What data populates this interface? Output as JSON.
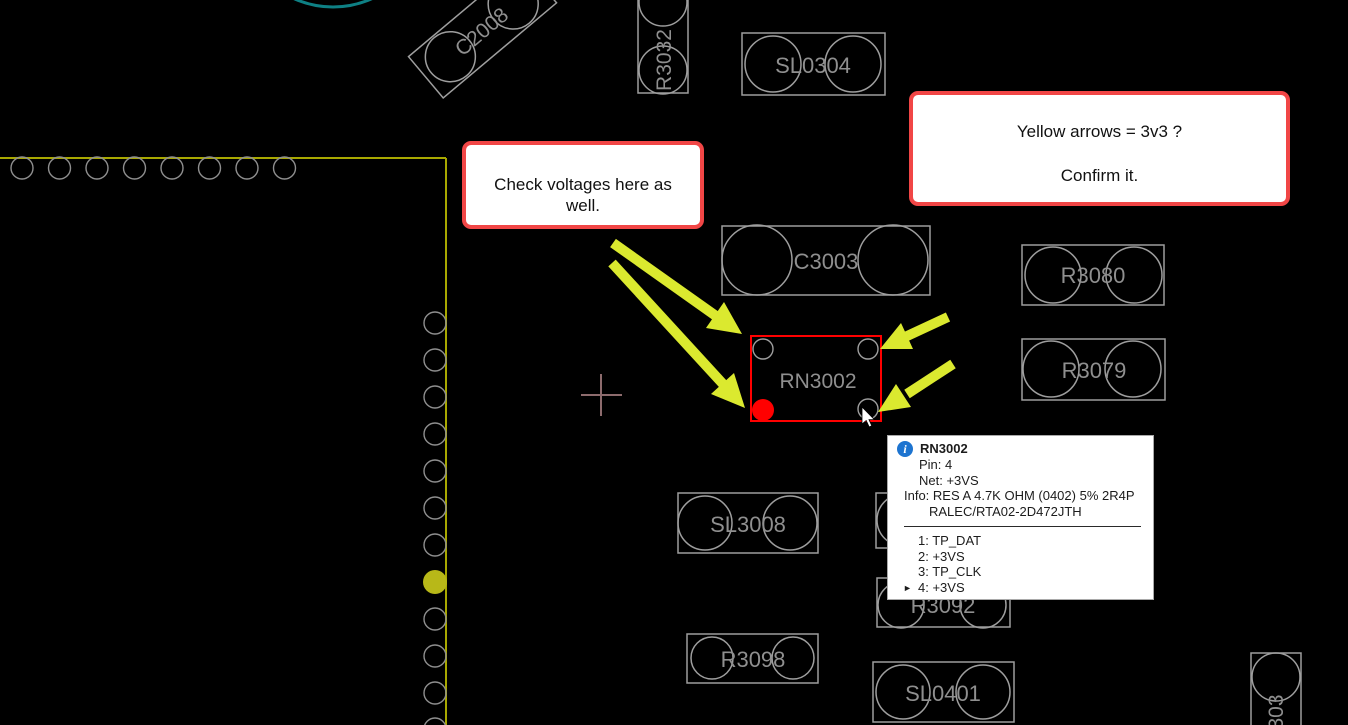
{
  "annotations": {
    "note1": {
      "text": "Check voltages here as well."
    },
    "note2": {
      "line1": "Yellow arrows = 3v3 ?",
      "line2": "Confirm it."
    }
  },
  "tooltip": {
    "title": "RN3002",
    "pin": "Pin: 4",
    "net": "Net: +3VS",
    "info1": "Info: RES A 4.7K OHM (0402) 5% 2R4P",
    "info2": "RALEC/RTA02-2D472JTH",
    "pins": [
      "1: TP_DAT",
      "2: +3VS",
      "3: TP_CLK",
      "4: +3VS"
    ],
    "selected_marker": "►",
    "icon_glyph": "i"
  },
  "board": {
    "components": [
      {
        "label": "C2008"
      },
      {
        "label": "R3032"
      },
      {
        "label": "SL0304"
      },
      {
        "label": "C3003"
      },
      {
        "label": "R3080"
      },
      {
        "label": "R3079"
      },
      {
        "label": "RN3002"
      },
      {
        "label": "SL3008"
      },
      {
        "label": "R3092"
      },
      {
        "label": "R3098"
      },
      {
        "label": "SL0401"
      },
      {
        "label": "303"
      }
    ],
    "colors": {
      "outline": "#9e9e9e",
      "label": "#8f8f8f",
      "board_edge": "#a8a800",
      "highlight": "#ff0000",
      "arrow": "#dbe92f",
      "net_dot": "#b8b818",
      "teal": "#0e8084",
      "crosshair": "#8d6b6d"
    }
  }
}
